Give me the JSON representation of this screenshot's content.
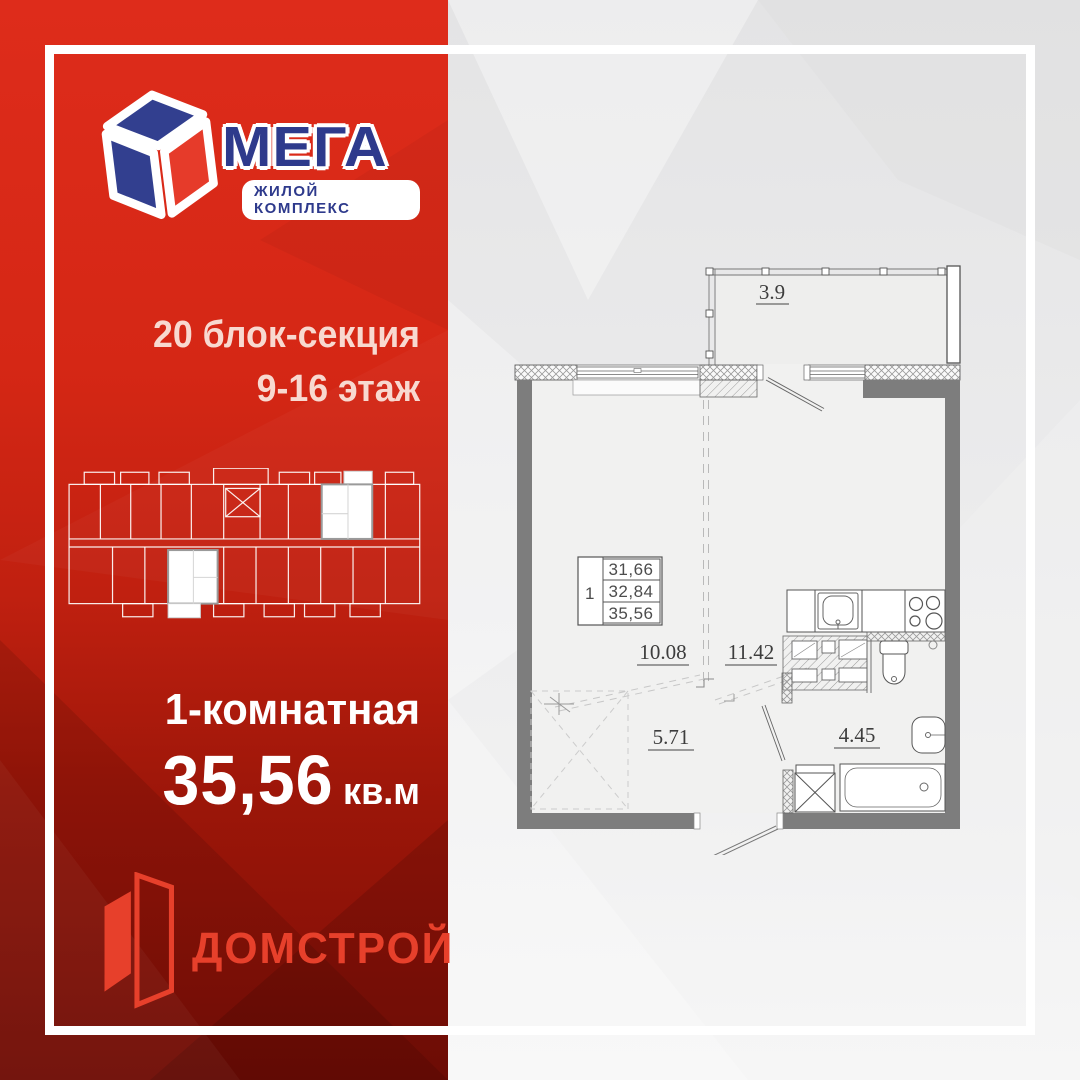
{
  "brand": {
    "name": "МЕГА",
    "tagline": "ЖИЛОЙ КОМПЛЕКС"
  },
  "developer": {
    "name": "ДОМСТРОЙ"
  },
  "offer": {
    "block": "20 блок-секция",
    "floors": "9-16 этаж",
    "apartment_type": "1-комнатная",
    "area": "35,56",
    "area_unit": "кв.м"
  },
  "plan": {
    "stamp": {
      "rooms": "1",
      "living_area": "31,66",
      "apartment_area": "32,84",
      "total_area": "35,56"
    },
    "labels": {
      "balcony": "3.9",
      "room": "10.08",
      "kitchen": "11.42",
      "hall": "5.71",
      "bath": "4.45"
    }
  },
  "colors": {
    "red_top": "#de2c1b",
    "red_bottom": "#7c0e06",
    "accent_red": "#e7402b",
    "navy": "#2e3a8c",
    "bg_gray": "#e9e9ea",
    "wall_gray": "#7d7d7d"
  }
}
